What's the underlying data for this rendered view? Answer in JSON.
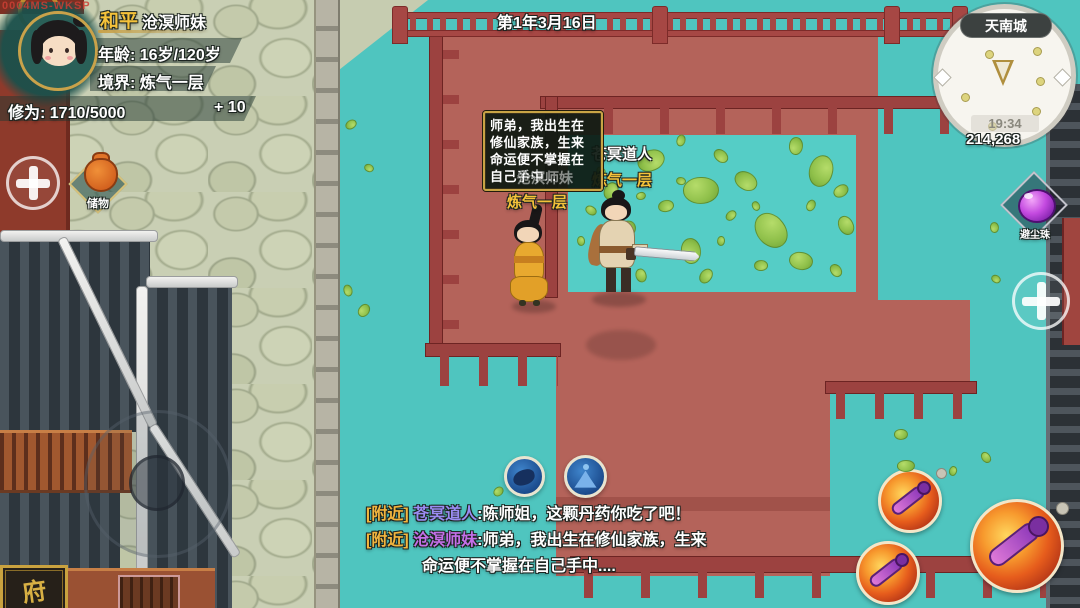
{
  "watermark": "0004MS-WKSP",
  "hud": {
    "player": {
      "name": "和平",
      "title": "沧溟师妹",
      "age_label": "年龄: 16岁/120岁",
      "realm_label": "境界: 炼气一层",
      "cultivation_label": "修为: 1710/5000",
      "cultivation_gain": "+ 10"
    },
    "date": "第1年3月16日",
    "minimap": {
      "location": "天南城",
      "time": "19:34",
      "currency": "214,268"
    },
    "storage_item": {
      "label": "储物"
    },
    "pearl_item": {
      "label": "避尘珠"
    },
    "icons": {
      "skill1": "beast-skill-icon",
      "skill2": "meditation-skill-icon",
      "attack": "sword-attack-icon",
      "plus": "plus-icon",
      "storage": "bag-icon",
      "pearl": "pearl-icon",
      "marker": "player-marker-icon"
    }
  },
  "scene": {
    "npc": {
      "name": "苍冥道人",
      "realm": "炼气一层"
    },
    "player_char": {
      "name": "沧溟师妹",
      "realm": "炼气一层"
    },
    "speech_bubble": {
      "lines": [
        "师弟，我出生在",
        "修仙家族，生来",
        "命运便不掌握在",
        "自己手中..."
      ]
    },
    "sign": "府"
  },
  "chat": {
    "messages": [
      {
        "channel": "[附近]",
        "speaker": "苍冥道人",
        "sep": ":",
        "text": "陈师姐，这颗丹药你吃了吧！"
      },
      {
        "channel": "[附近]",
        "speaker": "沧溟师妹",
        "sep": ":",
        "text": "师弟，我出生在修仙家族，生来"
      },
      {
        "channel": "",
        "speaker": "",
        "sep": "",
        "text": "命运便不掌握在自己手中...."
      }
    ]
  },
  "colors": {
    "water": "#4fc5bf",
    "platform_red": "#b4635a",
    "railing_red": "#9c4240",
    "gold": "#f5c23a",
    "chat_channel": "#f2b53e",
    "chat_speaker_npc": "#9a8cf2",
    "chat_speaker_player": "#c46fe8"
  }
}
